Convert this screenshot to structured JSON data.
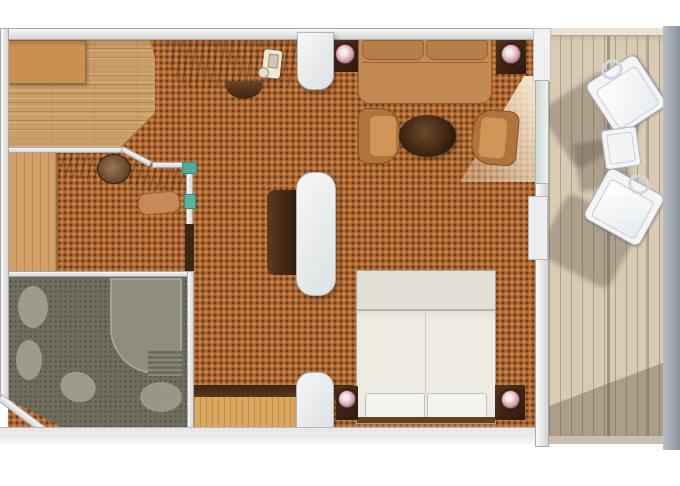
{
  "scene": "suite-floor-plan-with-balcony",
  "rooms": [
    {
      "id": "dining",
      "name": "dining-entry-area-wood-floor"
    },
    {
      "id": "living",
      "name": "living-sitting-area"
    },
    {
      "id": "dressing",
      "name": "dressing-room"
    },
    {
      "id": "bathroom",
      "name": "bathroom"
    },
    {
      "id": "bedroom",
      "name": "bedroom"
    },
    {
      "id": "balcony",
      "name": "private-balcony"
    }
  ],
  "furniture": [
    {
      "room": "dining",
      "item": "dining-table"
    },
    {
      "room": "living",
      "item": "writing-desk"
    },
    {
      "room": "living",
      "item": "telephone"
    },
    {
      "room": "living",
      "item": "desk-chair"
    },
    {
      "room": "living",
      "item": "side-table-with-lamp"
    },
    {
      "room": "living",
      "item": "sofa"
    },
    {
      "room": "living",
      "item": "side-table-with-lamp"
    },
    {
      "room": "living",
      "item": "armchair"
    },
    {
      "room": "living",
      "item": "round-coffee-table"
    },
    {
      "room": "living",
      "item": "armchair"
    },
    {
      "room": "dressing",
      "item": "wardrobe"
    },
    {
      "room": "dressing",
      "item": "vanity-counter"
    },
    {
      "room": "dressing",
      "item": "vanity-mirror"
    },
    {
      "room": "dressing",
      "item": "vanity-bench"
    },
    {
      "room": "bedroom",
      "item": "divider-cabinet"
    },
    {
      "room": "bedroom",
      "item": "double-bed"
    },
    {
      "room": "bedroom",
      "item": "pillow"
    },
    {
      "room": "bedroom",
      "item": "pillow"
    },
    {
      "room": "bedroom",
      "item": "nightstand-with-lamp"
    },
    {
      "room": "bedroom",
      "item": "nightstand-with-lamp"
    },
    {
      "room": "bathroom",
      "item": "shower-enclosure"
    },
    {
      "room": "bathroom",
      "item": "washbasin"
    },
    {
      "room": "bathroom",
      "item": "toilet"
    },
    {
      "room": "bathroom",
      "item": "bath-mat"
    },
    {
      "room": "balcony",
      "item": "lounge-chair"
    },
    {
      "room": "balcony",
      "item": "balcony-side-table"
    },
    {
      "room": "balcony",
      "item": "lounge-chair"
    }
  ],
  "structure": [
    "top-wall",
    "left-wall",
    "bottom-wall",
    "interior-wall-dressing",
    "interior-wall-bathroom",
    "angled-corner-wall",
    "balcony-partition-wall",
    "balcony-glass-door",
    "open-door-light-beam",
    "pillar-top",
    "pillar-middle",
    "pillar-bottom",
    "balcony-outer-edge"
  ],
  "colors": {
    "background": "#ffffff",
    "wall_gray": "#d4d4d4",
    "carpet_orange": "#ab6531",
    "carpet_dot_dark": "#5f3a18",
    "wood_floor": "#c99e68",
    "wardrobe_wood": "#d2a066",
    "entry_wood": "#d9a75f",
    "dark_wood_furniture": "#3c2412",
    "upholstery_tan": "#c28b53",
    "bed_linen": "#eae8e2",
    "bathroom_tile": "#6f6d5b",
    "bathroom_fixture": "#a3a293",
    "deck_planks": "#d9cab4",
    "balcony_furniture_white": "#f3f5f7",
    "pillar_white": "#eef0f1",
    "glass_teal": "#4fae9f",
    "lamp_pink": "#d7a6af",
    "outer_band_gray": "#8d939b",
    "shadow": "rgba(86,74,60,0.35)"
  }
}
